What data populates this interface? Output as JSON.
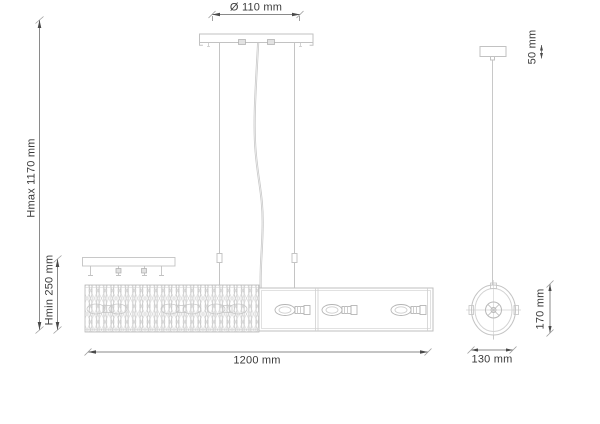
{
  "drawing": {
    "labels": {
      "canopy_diameter": "Ø 110 mm",
      "max_height": "Hmax 1170 mm",
      "min_height": "Hmin 250 mm",
      "fixture_length": "1200 mm",
      "side_profile_width": "130 mm",
      "side_profile_height": "170 mm",
      "side_canopy_height": "50 mm"
    },
    "colors": {
      "background": "#ffffff",
      "artwork_line": "#c4c4c4",
      "artwork_line_light": "#d6d6d6",
      "dimension_line": "#8a8a8a",
      "arrow_fill": "#4a4a4a",
      "text": "#3a3a3a"
    }
  }
}
